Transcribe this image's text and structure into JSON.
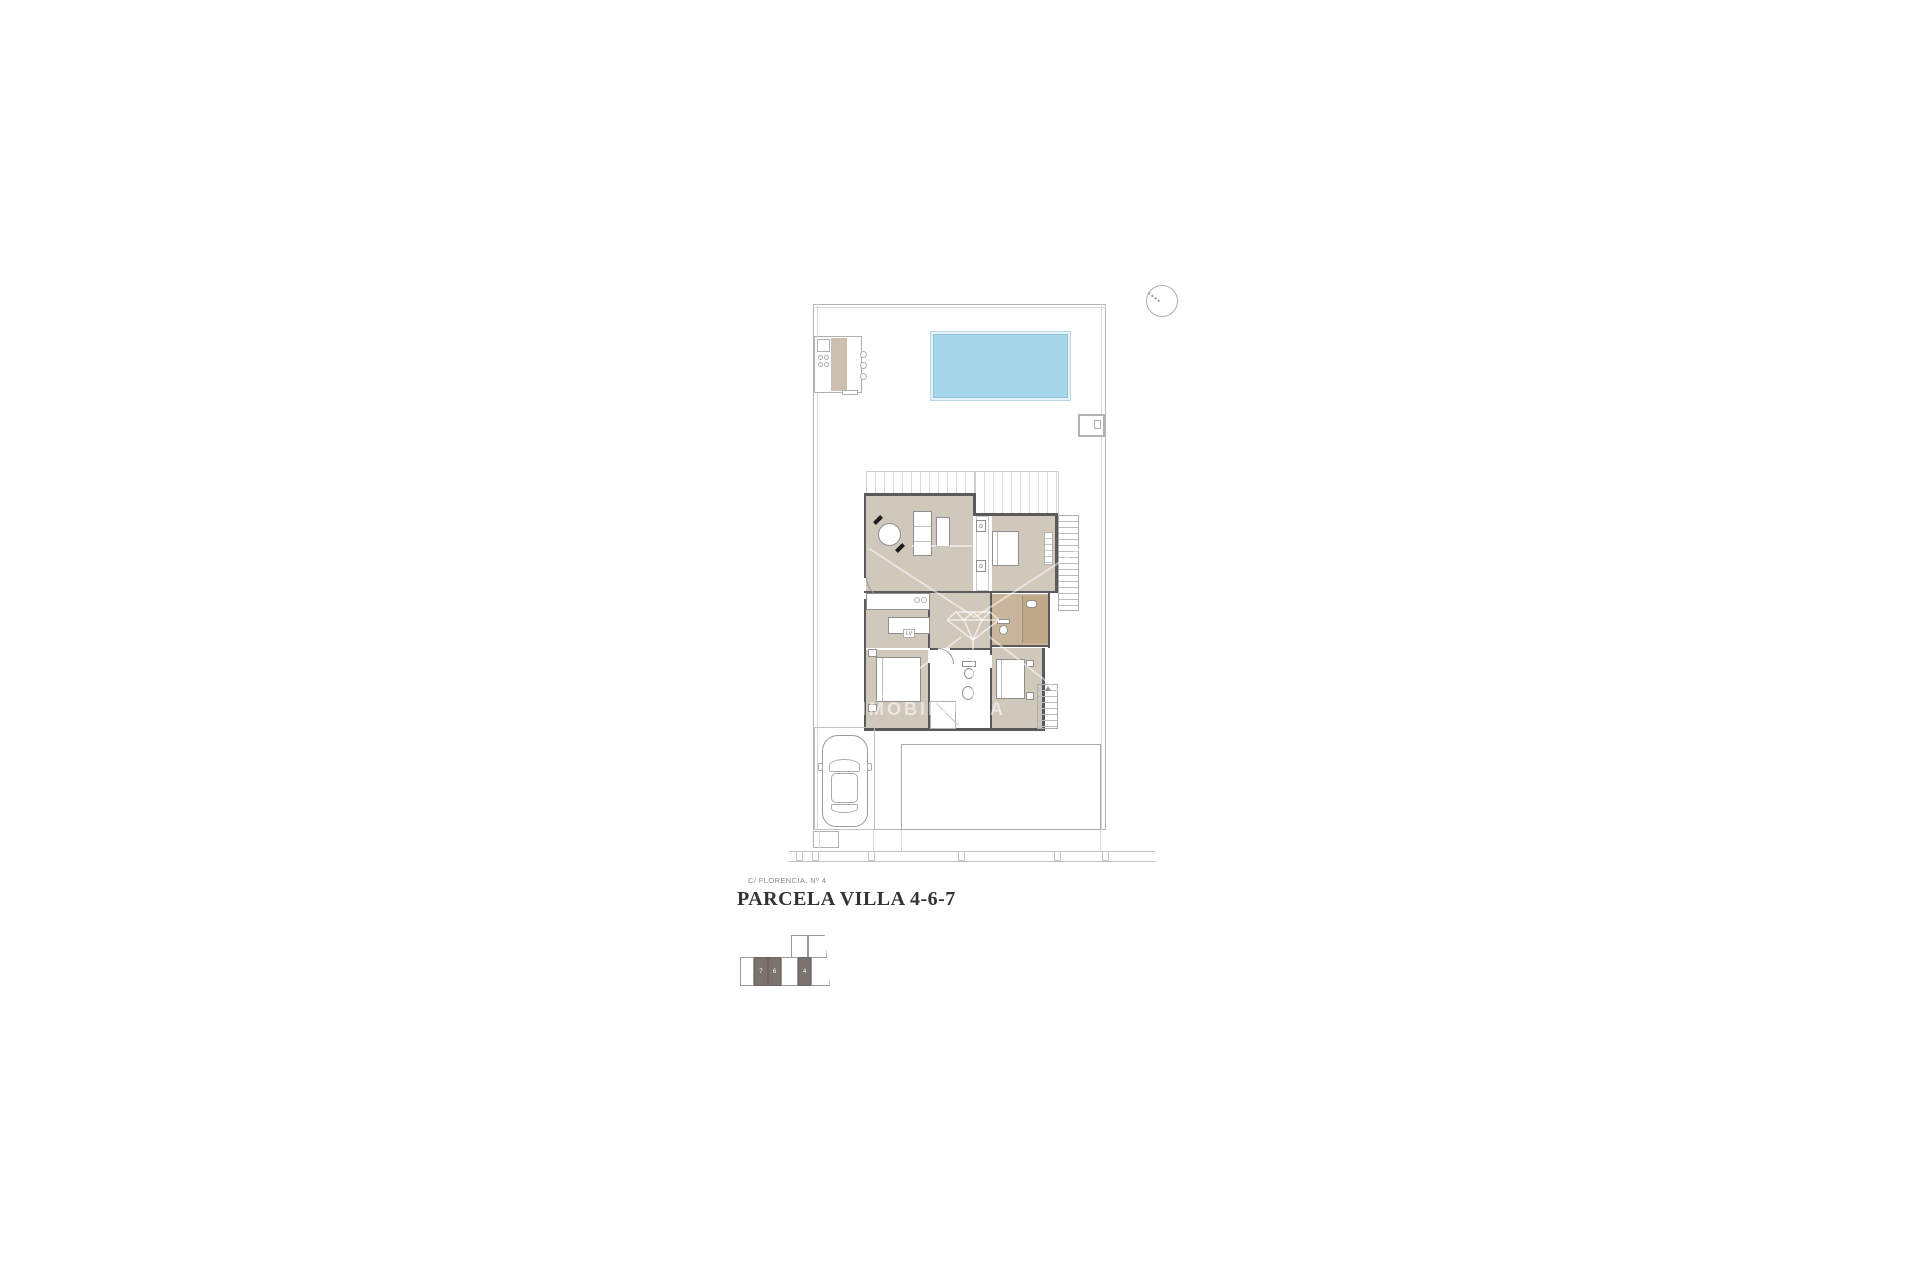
{
  "texts": {
    "address": "C/ FLORENCIA, Nº 4",
    "title": "PARCELA VILLA 4-6-7",
    "watermark": "INMOBILIARIA",
    "kitchen_label": "LV"
  },
  "key_plan": {
    "villa_numbers": [
      "7",
      "6",
      "4"
    ]
  },
  "colors": {
    "pool": "#a7d6ea",
    "pool_coping": "#e7f2f8",
    "floor": "#d1c8bc",
    "floor_warm": "#c8b59b",
    "wall": "#5a5a5a",
    "boundary": "#b5b5b5",
    "keyplan_dark": "#7b736e",
    "title_text": "#333333",
    "address_text": "#8a8a8a"
  }
}
